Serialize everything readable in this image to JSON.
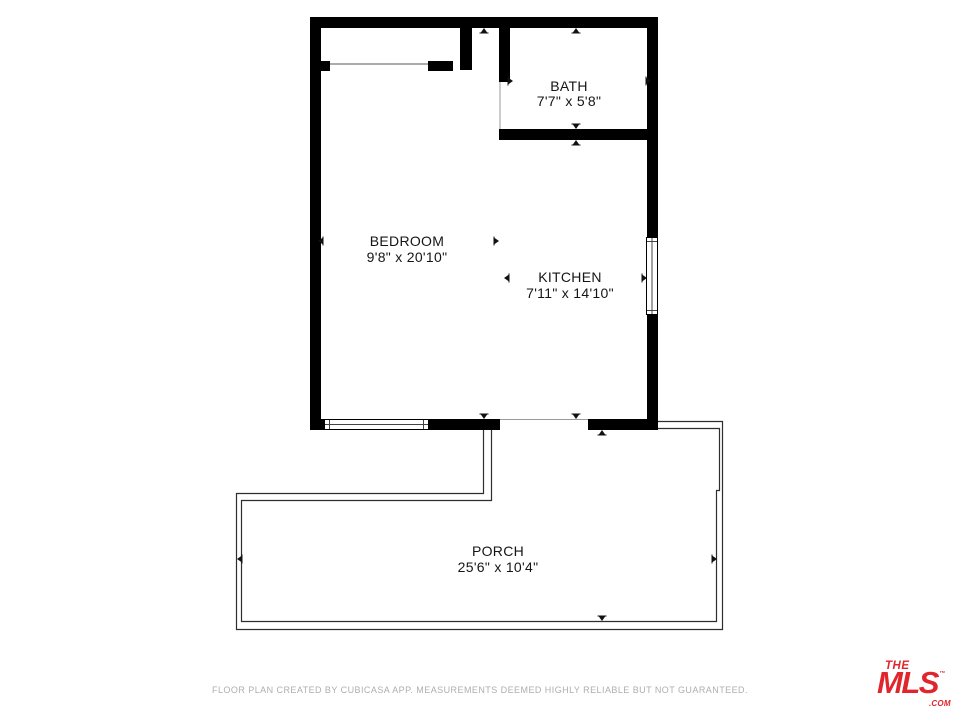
{
  "plan": {
    "rooms": {
      "bath": {
        "name": "BATH",
        "dimensions": "7'7\" x 5'8\""
      },
      "bedroom": {
        "name": "BEDROOM",
        "dimensions": "9'8\" x 20'10\""
      },
      "kitchen": {
        "name": "KITCHEN",
        "dimensions": "7'11\" x 14'10\""
      },
      "porch": {
        "name": "PORCH",
        "dimensions": "25'6\" x 10'4\""
      }
    },
    "colors": {
      "wall": "#000000",
      "porch_outline": "#2e2e2e",
      "label": "#151515",
      "disclaimer": "#aeaeae",
      "brand_red": "#e0252c"
    }
  },
  "footer": {
    "disclaimer": "FLOOR PLAN CREATED BY CUBICASA APP. MEASUREMENTS DEEMED HIGHLY RELIABLE BUT NOT GUARANTEED."
  },
  "branding": {
    "the": "THE",
    "mls": "MLS",
    "tm": "™",
    "com": ".COM"
  }
}
